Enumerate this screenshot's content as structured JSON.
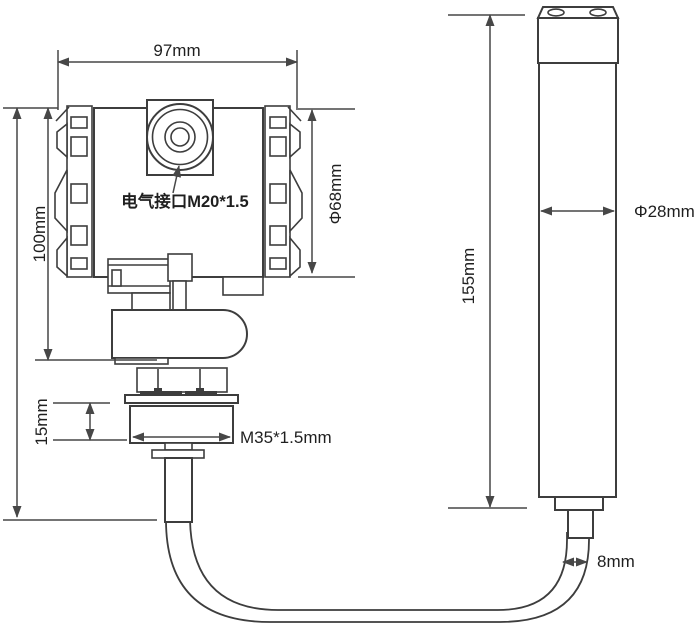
{
  "drawing": {
    "type": "engineering-dimension-drawing",
    "subject": "submersible level transmitter with probe and cable",
    "views": [
      "transmitter-with-process-connection",
      "sensor-probe"
    ]
  },
  "colors": {
    "line": "#3d3d3d",
    "dim": "#474747",
    "ink": "#1f1f1f",
    "bg": "#ffffff"
  },
  "labels": {
    "housing_width": "97mm",
    "housing_height": "100mm",
    "housing_diameter": "Φ68mm",
    "electrical_interface": "电气接口M20*1.5",
    "thread_length": "15mm",
    "thread_spec": "M35*1.5mm",
    "probe_length": "155mm",
    "probe_diameter": "Φ28mm",
    "cable_diameter": "8mm"
  }
}
